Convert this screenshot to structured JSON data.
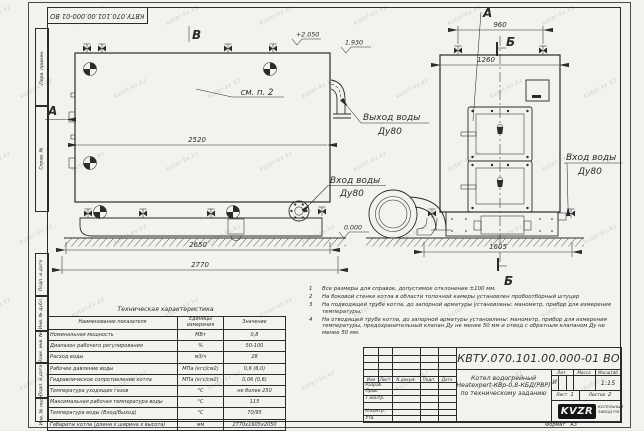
{
  "colors": {
    "paper": "#f3f2ef",
    "ink": "#2b2b2b",
    "logo_bg": "#141414"
  },
  "watermark": {
    "text": "kotel-kv.kz"
  },
  "stamp_top": "КВТУ.070.101.00.000-01 ВО",
  "margin_blocks": [
    "Перв. примен.",
    "Справ. №",
    "Подп. и дата",
    "Инв. № дубл.",
    "Взам. инв. №",
    "Подп. и дата",
    "Инв. № подл."
  ],
  "drawing": {
    "view_b": "В",
    "view_a_side": "А",
    "view_a_top": "А",
    "sec_b_top": "Б",
    "sec_b_bottom": "Б",
    "see_note": "см. п. 2",
    "elev_top": "+2.050",
    "elev_mid": "1.930",
    "elev_zero": "0.000",
    "dim_2520": "2520",
    "dim_2650": "2650",
    "dim_2770": "2770",
    "dim_960": "960",
    "dim_1260": "1260",
    "dim_1605": "1605",
    "out_l1": "Выход воды",
    "out_l2": "Ду80",
    "in_mid_l1": "Вход воды",
    "in_mid_l2": "Ду80",
    "in_r_l1": "Вход воды",
    "in_r_l2": "Ду80"
  },
  "tech_table": {
    "title": "Техническая характеристика",
    "headers": {
      "name": "Наименование показателя",
      "units": "Единицы измерения",
      "value": "Значение"
    },
    "rows": [
      {
        "name": "Номинальная мощность",
        "units": "МВт",
        "value": "0,8"
      },
      {
        "name": "Диапазон рабочего регулирования",
        "units": "%",
        "value": "50-100"
      },
      {
        "name": "Расход воды",
        "units": "м3/ч",
        "value": "28"
      },
      {
        "name": "Рабочее давление воды",
        "units": "МПа (кгс/см2)",
        "value": "0,6 (6,0)"
      },
      {
        "name": "Гидравлическое сопротивление котла",
        "units": "МПа (кгс/см2)",
        "value": "0,06 (0,6)"
      },
      {
        "name": "Температура уходящих газов",
        "units": "°С",
        "value": "не более 250"
      },
      {
        "name": "Максимальная рабочая температура воды",
        "units": "°С",
        "value": "115"
      },
      {
        "name": "Температура воды (Вход/Выход)",
        "units": "°С",
        "value": "70/95"
      },
      {
        "name": "Габариты котла (длина х ширина х высота)",
        "units": "мм",
        "value": "2770х1605х2050"
      }
    ]
  },
  "notes": {
    "items": [
      {
        "num": "1",
        "text": "Все размеры для справок, допустимое отклонение ±100 мм."
      },
      {
        "num": "2",
        "text": "На боковой стенке котла в области топочной камеры установлен пробоотборный штуцер"
      },
      {
        "num": "3",
        "text": "На подводящей трубе котла, до запорной арматуры установлены: манометр, прибор для измерения температуры."
      },
      {
        "num": "4",
        "text": "На отводящей трубе котла, до запорной арматуры установлены: манометр, прибор для измерения температуры, предохранительный клапан Ду не менее 50 мм и отвод с обратным клапаном Ду не менее 50 мм."
      }
    ]
  },
  "title_block": {
    "doc_number": "КВТУ.070.101.00.000-01 ВО",
    "header_cols": [
      "Изм",
      "Лист",
      "N докум.",
      "Подп.",
      "Дата"
    ],
    "staff_rows": [
      "Разраб.",
      "Пров.",
      "Т.контр.",
      "",
      "Н.контр.",
      "Утв."
    ],
    "name_line1": "Котел водогрейный",
    "name_line2": "Heatexpert-КВр-0,8-КБД(РВР)",
    "name_line3": "по техническому заданию",
    "lit_header": "Лит.",
    "mass_header": "Масса",
    "scale_header": "Масштаб",
    "lit_value": "И",
    "scale_value": "1:15",
    "sheet_label": "Лист",
    "sheet_value": "1",
    "sheets_label": "Листов",
    "sheets_value": "2",
    "logo_text": "KVZR",
    "logo_caption_line1": "КОТЕЛЬНЫЙ",
    "logo_caption_line2": "ЗАВОД РЭП",
    "format_label": "Формат",
    "format_value": "А3"
  }
}
